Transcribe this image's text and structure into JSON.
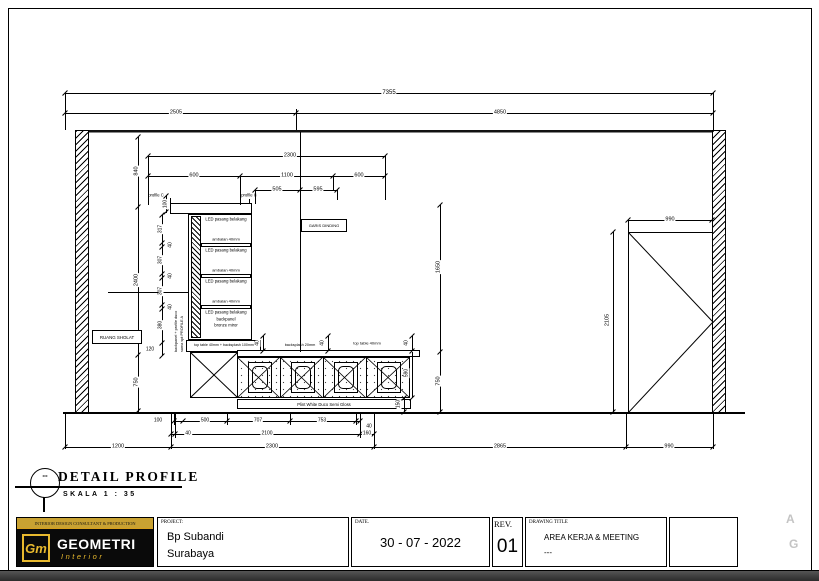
{
  "dims": {
    "top_total": "7355",
    "top_left": "2505",
    "top_right": "4850",
    "w2300": "2300",
    "w600l": "600",
    "w1100": "1100",
    "w600r": "600",
    "w505": "505",
    "w595": "595",
    "h840": "840",
    "h2400": "2400",
    "h750": "750",
    "c100": "100",
    "c317": "317",
    "c40a": "40",
    "c307a": "307",
    "c40b": "40",
    "c307b": "307",
    "c40c": "40",
    "c380": "380",
    "c120": "120",
    "m1650": "1650",
    "m750": "750",
    "d40l": "40",
    "d40m": "40",
    "d40r": "40",
    "d590": "590",
    "d150": "150",
    "r990": "990",
    "r2105": "2105",
    "a100": "100",
    "a500": "500",
    "a707": "707",
    "a753": "753",
    "a40": "40",
    "b40": "40",
    "b2100": "2100",
    "b160": "160",
    "g1200": "1200",
    "g2300": "2300",
    "g2865": "2865",
    "g990": "990"
  },
  "annotations": {
    "profile_c": "profile C",
    "led": "LED pasang belakang",
    "ambalan": "ambalan 40mm",
    "backpanel_line1": "backpanel",
    "backpanel_line2": "bronze miror",
    "side_note_1": "backpanel + profile duco",
    "side_note_2": "sama spt PROFILE A",
    "cabinet_base_note": "top table 40mm + backsplash 100mm",
    "desk_mid_note": "backsplash 20mm",
    "desk_top_note": "top table 40mm",
    "plint_note": "Plint White Duco Semi Gloss",
    "garis_dinding": "GARIS DINDING",
    "ruang_sholat": "RUANG SHOLAT"
  },
  "section": {
    "title": "DETAIL PROFILE",
    "scale": "SKALA 1 : 35",
    "marker": "--"
  },
  "titleblock": {
    "tagline": "INTERIOR DESIGN CONSULTANT & PRODUCTION",
    "logo_monogram": "Gm",
    "logo_name": "GEOMETRI",
    "logo_sub": "Interior",
    "project_label": "PROJECT:",
    "project_name": "Bp Subandi",
    "project_city": "Surabaya",
    "date_label": "DATE.",
    "date_value": "30 - 07 - 2022",
    "rev_label": "REV.",
    "rev_value": "01",
    "drawing_label": "DRAWING TITLE",
    "drawing_title": "AREA KERJA & MEETING",
    "drawing_sub": "---"
  },
  "edge_marks": {
    "a": "A",
    "g": "G"
  },
  "colors": {
    "accent_gold": "#d8a01d",
    "line": "#000000"
  }
}
